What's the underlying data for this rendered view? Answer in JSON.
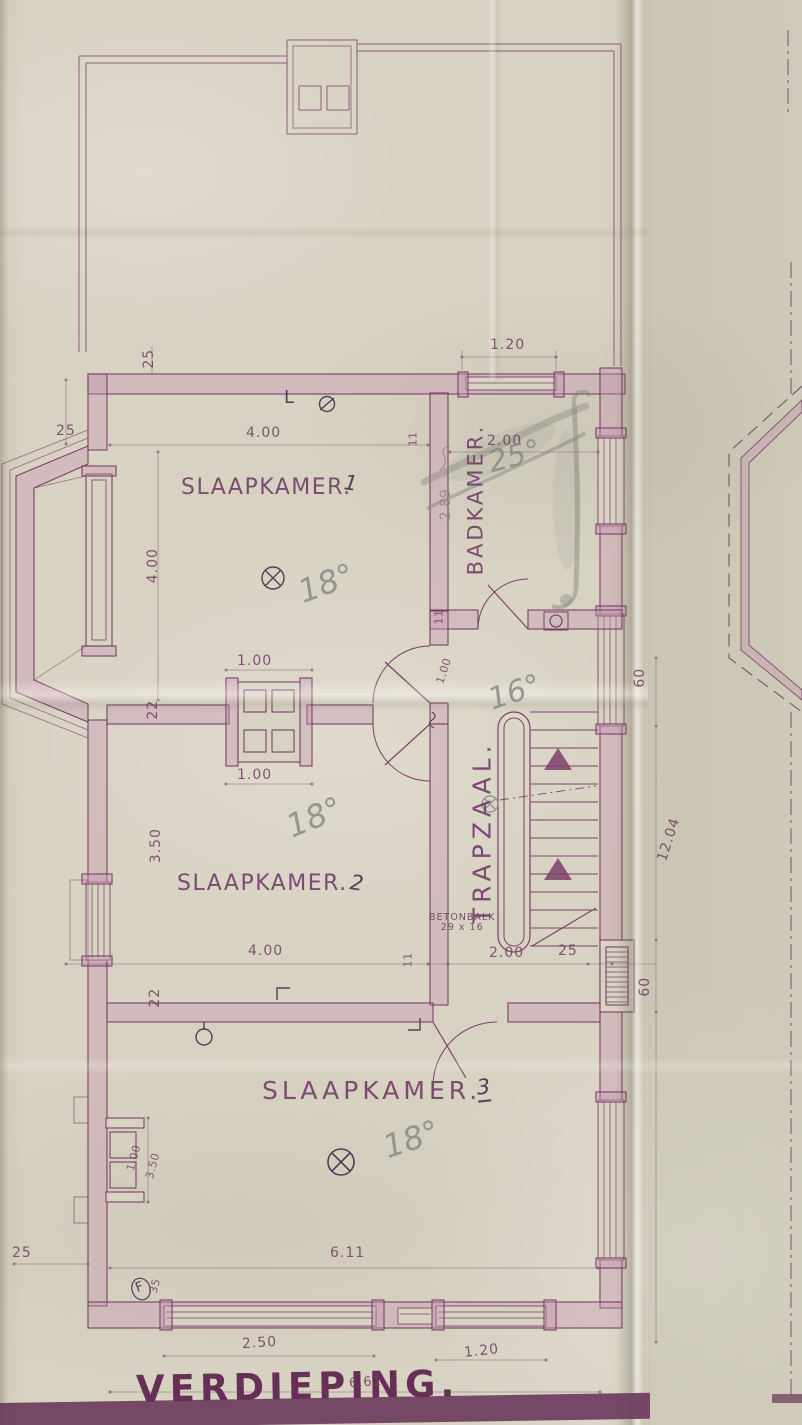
{
  "title": "VERDIEPING.",
  "rooms": {
    "r1": {
      "label": "SLAAPKAMER.",
      "num": "1"
    },
    "r2": {
      "label": "SLAAPKAMER.",
      "num": "2"
    },
    "r3": {
      "label": "SLAAPKAMER.",
      "num": "3"
    },
    "bad": {
      "label": "BADKAMER."
    },
    "trap": {
      "label": "TRAPZAAL."
    }
  },
  "pencil": {
    "temp_sl1": "18°",
    "temp_sl2": "18°",
    "temp_sl3": "18°",
    "temp_trap": "16°",
    "temp_bad": "25°",
    "dim_bad": "2.89"
  },
  "note": {
    "l1": "BETONBALK",
    "l2": "29 x 16"
  },
  "sym": {
    "f": "F",
    "l_mark": "L"
  },
  "dims": {
    "a25_top": "25",
    "a25_left": "25",
    "sl1_w": "4.00",
    "sl1_h": "4.00",
    "w11_top": "11",
    "bad_win": "1.20",
    "bad_w": "2.00",
    "w11_bad": "11",
    "bad_door": "1.00",
    "chim_top": "1.00",
    "chim_bot": "1.00",
    "sl2_22": "22",
    "sl2_h": "3.50",
    "sl2_w": "4.00",
    "w11_bot": "11",
    "trap_w": "2.00",
    "trap_25": "25",
    "win60_a": "60",
    "len1204": "12.04",
    "rad60": "60",
    "sl3_22": "22",
    "sl3_flue": "1.00",
    "sl3_chim": "3.50",
    "sl3_w": "6.11",
    "bl25": "25",
    "bl35": "35",
    "win250": "2.50",
    "total661": "6.61",
    "win120": "1.20"
  },
  "colors": {
    "ink": "#7b4068",
    "title_ink": "#662f56",
    "pencil": "#84897f",
    "paper": "#d6d0c1",
    "wall_fill": "#c8a0bb"
  }
}
